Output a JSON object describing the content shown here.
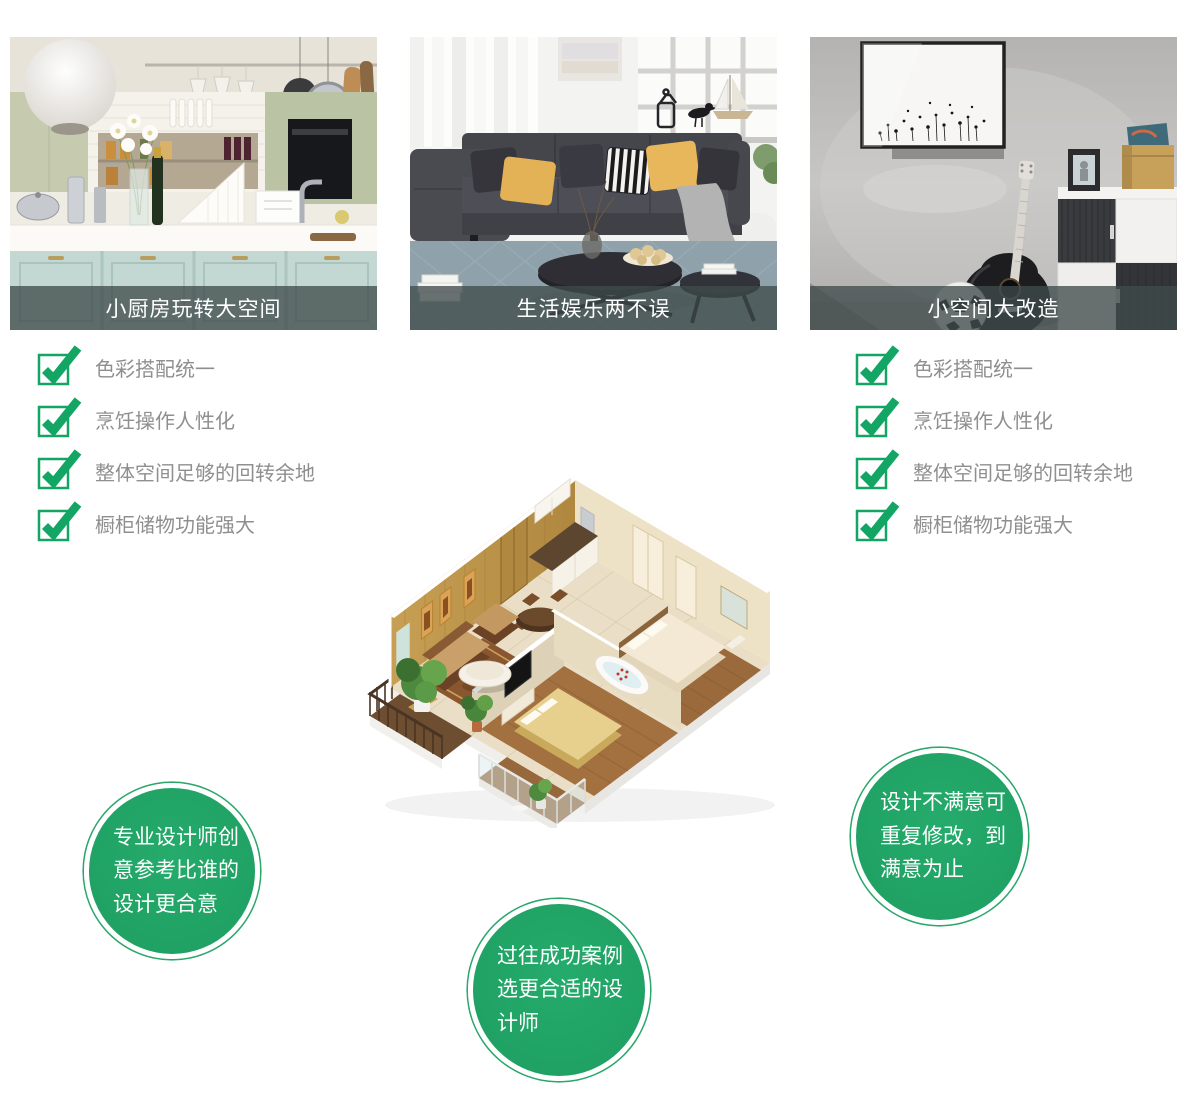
{
  "gallery": [
    {
      "caption": "小厨房玩转大空间"
    },
    {
      "caption": "生活娱乐两不误"
    },
    {
      "caption": "小空间大改造"
    }
  ],
  "checklist_left": {
    "items": [
      "色彩搭配统一",
      "烹饪操作人性化",
      "整体空间足够的回转余地",
      "橱柜储物功能强大"
    ]
  },
  "checklist_right": {
    "items": [
      "色彩搭配统一",
      "烹饪操作人性化",
      "整体空间足够的回转余地",
      "橱柜储物功能强大"
    ]
  },
  "bubbles": {
    "left": {
      "lines": [
        "专业设计师创",
        "意参考比谁的",
        "设计更合意"
      ]
    },
    "center": {
      "lines": [
        "过往成功案例",
        "选更合适的设",
        "计师"
      ]
    },
    "right": {
      "lines": [
        "设计不满意可",
        "重复修改，到",
        "满意为止"
      ]
    }
  },
  "colors": {
    "bubble_green": "#1fa464",
    "check_green": "#12a563",
    "caption_bg": "rgba(64,76,76,0.78)",
    "caption_text": "#ffffff",
    "checklist_text": "#8f8f8f"
  },
  "icons": {
    "checkmark": "check-icon"
  }
}
